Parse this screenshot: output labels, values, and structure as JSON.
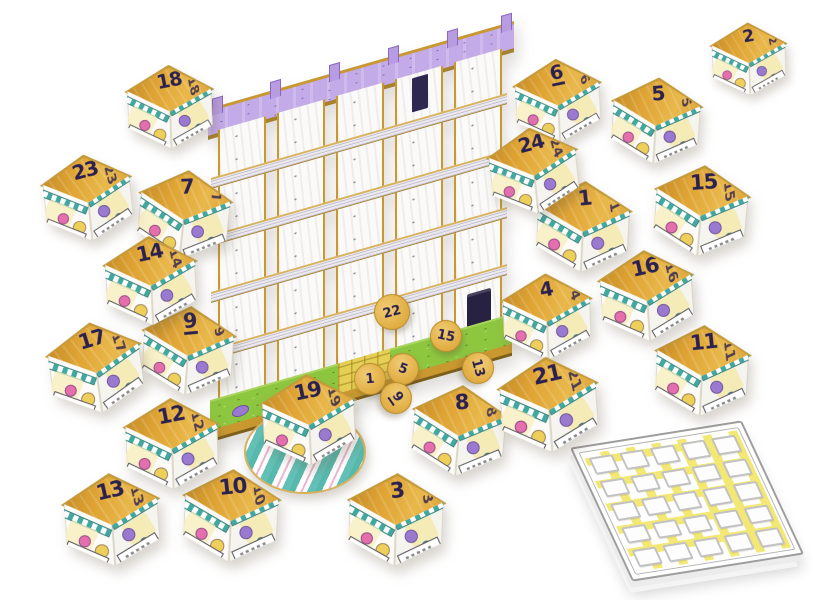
{
  "scene": {
    "description": "Product photo of a cardboard advent-calendar board game: numbered open boxes arranged around a five-storey shelf building with a purple roof and green base, yellow number tokens, a striped round disc under box 19, and a 5x5 grid score pad.",
    "background_color": "#ffffff"
  },
  "building": {
    "towers": 5,
    "floors": 5,
    "roof_fins": 6,
    "base_has_yellow_path": true,
    "dark_door_tower": 5,
    "dark_window_tower": 4
  },
  "boxes": [
    {
      "number": "1",
      "x": 583,
      "y": 228,
      "r": 3,
      "s": 1
    },
    {
      "number": "2",
      "x": 749,
      "y": 60,
      "r": -2,
      "s": 0.8
    },
    {
      "number": "3",
      "x": 396,
      "y": 521,
      "r": 2,
      "s": 1.02
    },
    {
      "number": "4",
      "x": 547,
      "y": 318,
      "r": -2,
      "s": 0.95
    },
    {
      "number": "5",
      "x": 656,
      "y": 122,
      "r": 4,
      "s": 0.95
    },
    {
      "number": "6",
      "x": 558,
      "y": 102,
      "r": -3,
      "s": 0.92
    },
    {
      "number": "7",
      "x": 184,
      "y": 216,
      "r": 6,
      "s": 0.98
    },
    {
      "number": "8",
      "x": 459,
      "y": 432,
      "r": 5,
      "s": 1
    },
    {
      "number": "9",
      "x": 188,
      "y": 352,
      "r": 4,
      "s": 0.98
    },
    {
      "number": "10",
      "x": 231,
      "y": 517,
      "r": 3,
      "s": 1.02
    },
    {
      "number": "11",
      "x": 702,
      "y": 372,
      "r": 3,
      "s": 1
    },
    {
      "number": "12",
      "x": 172,
      "y": 445,
      "r": -2,
      "s": 1
    },
    {
      "number": "13",
      "x": 112,
      "y": 521,
      "r": -4,
      "s": 1.02
    },
    {
      "number": "14",
      "x": 151,
      "y": 282,
      "r": -3,
      "s": 0.98
    },
    {
      "number": "15",
      "x": 701,
      "y": 212,
      "r": 5,
      "s": 1
    },
    {
      "number": "16",
      "x": 647,
      "y": 297,
      "r": -4,
      "s": 1
    },
    {
      "number": "17",
      "x": 96,
      "y": 369,
      "r": -8,
      "s": 1
    },
    {
      "number": "18",
      "x": 170,
      "y": 108,
      "r": -2,
      "s": 0.92
    },
    {
      "number": "19",
      "x": 309,
      "y": 421,
      "r": -3,
      "s": 1
    },
    {
      "number": "21",
      "x": 549,
      "y": 406,
      "r": -4,
      "s": 1.05
    },
    {
      "number": "23",
      "x": 88,
      "y": 199,
      "r": -6,
      "s": 0.95
    },
    {
      "number": "24",
      "x": 534,
      "y": 172,
      "r": -6,
      "s": 0.95
    }
  ],
  "tokens": [
    {
      "number": "22",
      "x": 392,
      "y": 312,
      "r": -15,
      "d": 34
    },
    {
      "number": "15",
      "x": 446,
      "y": 336,
      "r": 12,
      "d": 30
    },
    {
      "number": "13",
      "x": 478,
      "y": 368,
      "r": 75,
      "d": 30
    },
    {
      "number": "5",
      "x": 403,
      "y": 369,
      "r": 20,
      "d": 30
    },
    {
      "number": "1",
      "x": 370,
      "y": 379,
      "r": -5,
      "d": 30
    },
    {
      "number": "9",
      "x": 396,
      "y": 398,
      "r": 55,
      "d": 30
    }
  ],
  "disc": {
    "stripes": "teal-white-pink"
  },
  "notepad": {
    "grid_rows": 5,
    "grid_cols": 5
  },
  "palette": {
    "ink": "#2b2150",
    "box_gold": "#dfa434",
    "edge_gold": "#c9982f",
    "roof_purple": "#c3abe8",
    "base_green": "#8dc63f",
    "path_yellow": "#e5cf55",
    "token_gold": "#e3b148",
    "awning_teal": "#3fa9a0",
    "doodle_pink": "#e56fae",
    "doodle_purple": "#9a7ad0",
    "doodle_yellow": "#eecf5a",
    "pad_highlight": "#f0e146",
    "pad_line": "#c2c2c2",
    "door_navy": "#282242",
    "disc_teal": "#57b9ae",
    "disc_pink": "#edb6d3"
  }
}
